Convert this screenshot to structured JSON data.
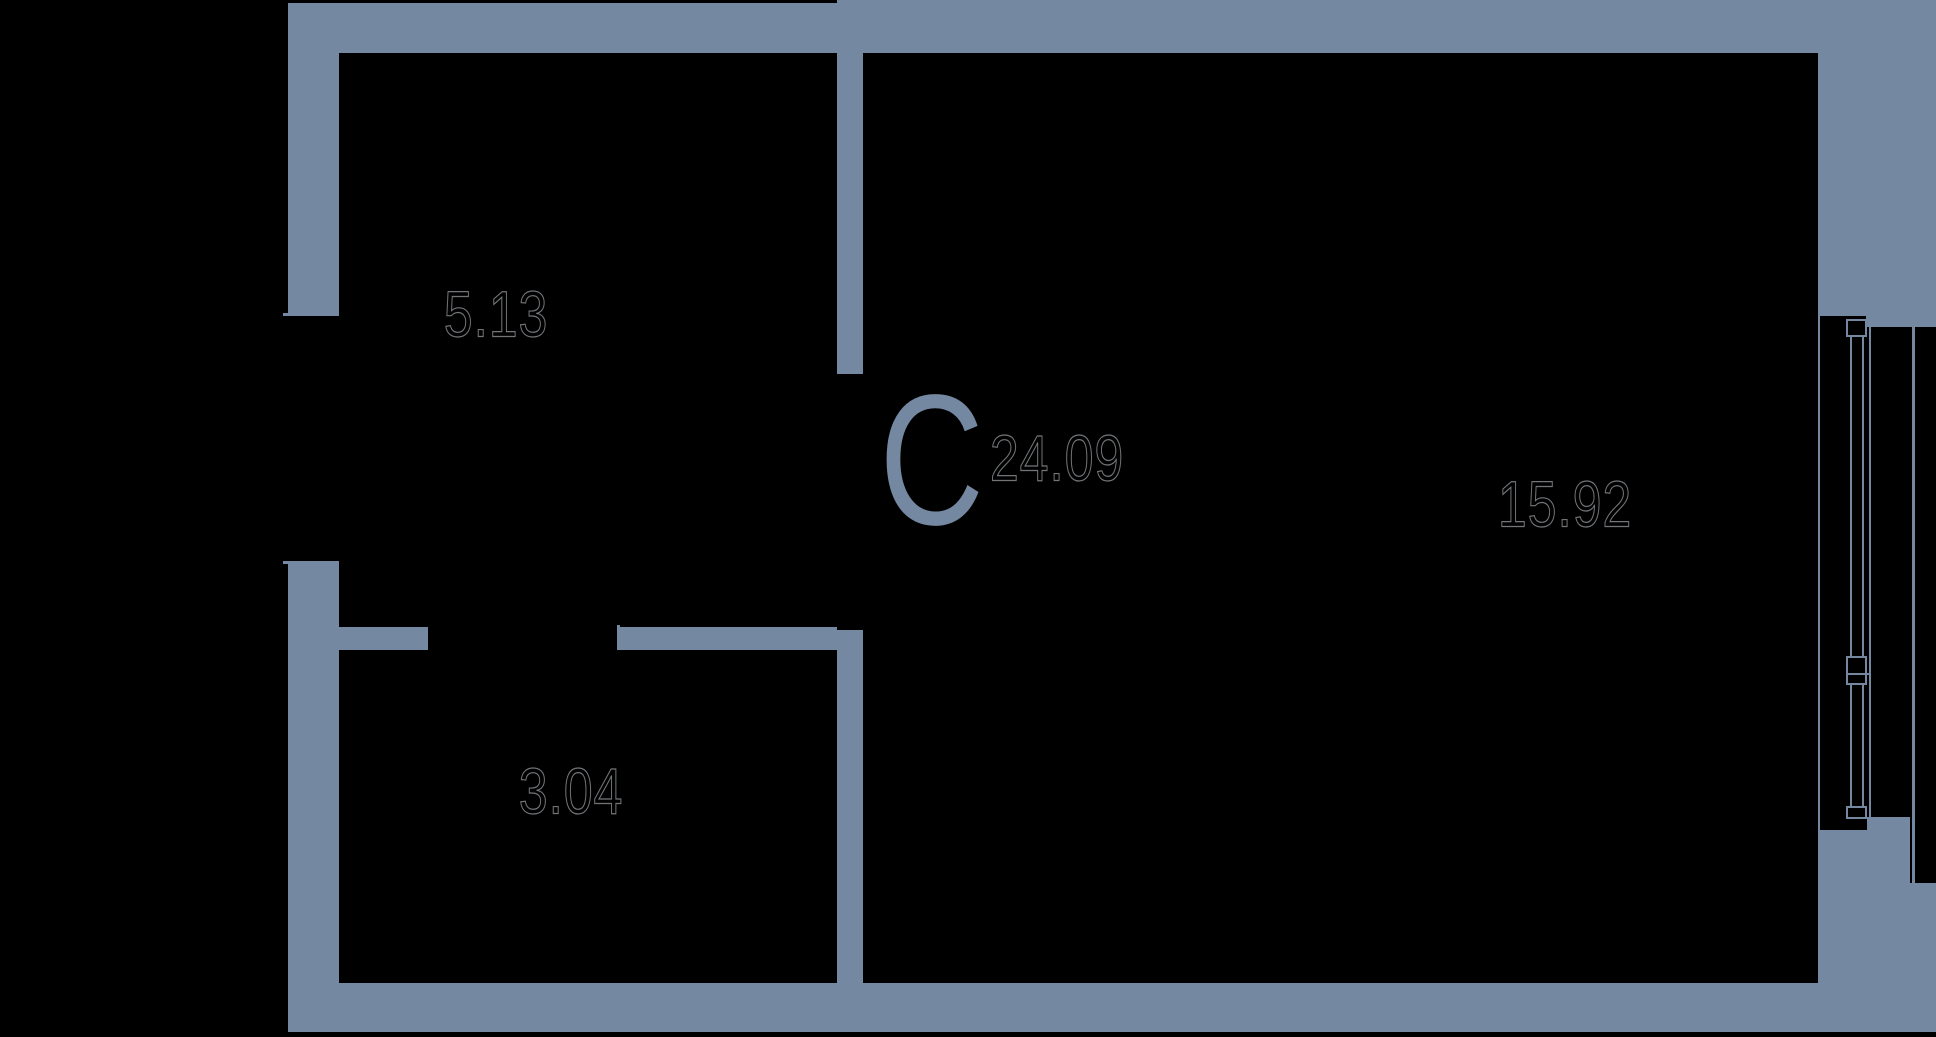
{
  "colors": {
    "background": "#000000",
    "wall": "#7489A1",
    "area_text_fill": "#000000",
    "area_text_outline": "#CAD0D6"
  },
  "plan": {
    "rooms": [
      {
        "key": "studio",
        "type_letter": "С",
        "area": "24.09"
      },
      {
        "key": "upper-left-room",
        "area": "5.13"
      },
      {
        "key": "lower-left-room",
        "area": "3.04"
      },
      {
        "key": "right-room",
        "area": "15.92"
      }
    ]
  }
}
